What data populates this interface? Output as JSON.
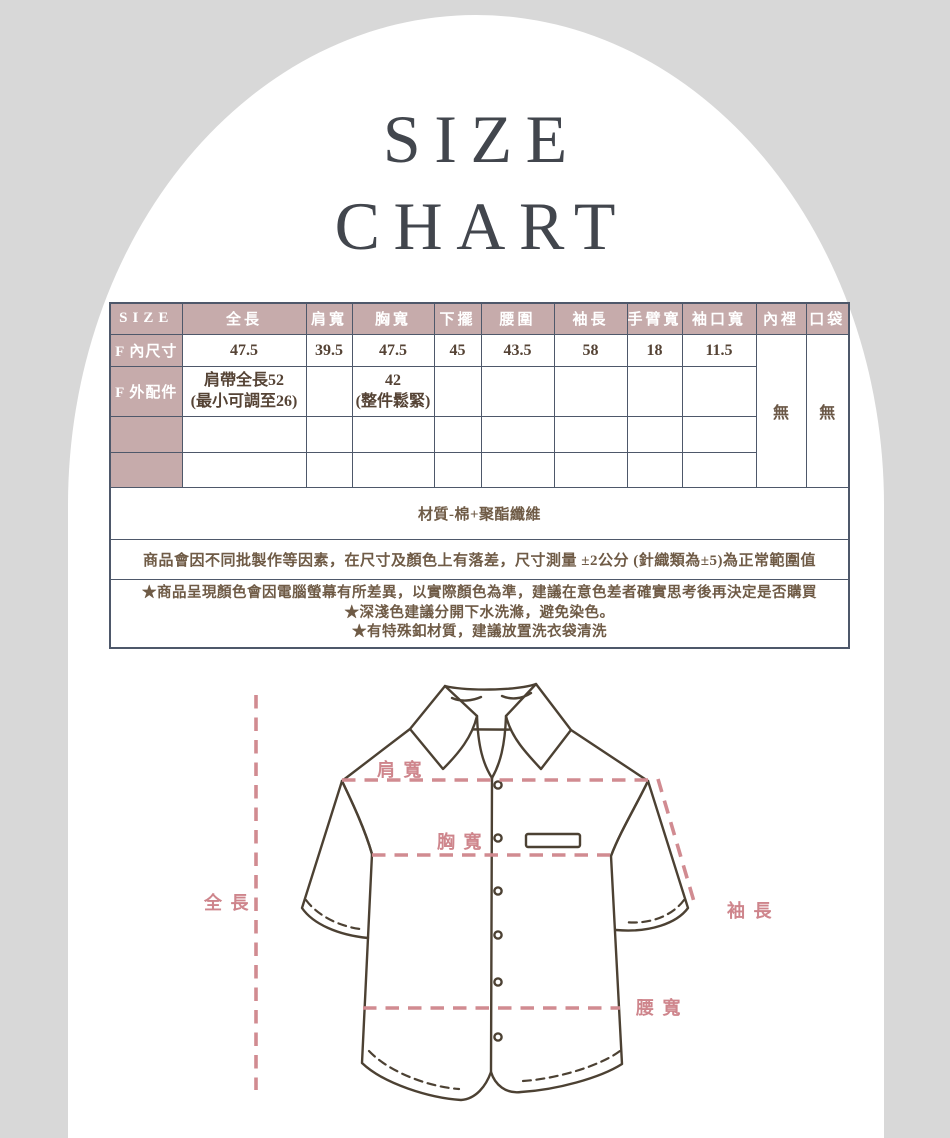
{
  "title": {
    "line1": "SIZE",
    "line2": "CHART"
  },
  "table": {
    "headers": [
      "SIZE",
      "全長",
      "肩寬",
      "胸寬",
      "下擺",
      "腰圍",
      "袖長",
      "手臂寬",
      "袖口寬",
      "內裡",
      "口袋"
    ],
    "row_inner": {
      "label": "F 內尺寸",
      "values": [
        "47.5",
        "39.5",
        "47.5",
        "45",
        "43.5",
        "58",
        "18",
        "11.5"
      ]
    },
    "row_outer": {
      "label": "F 外配件",
      "strap_note": "肩帶全長52\n(最小可調至26)",
      "chest_note": "42\n(整件鬆緊)"
    },
    "lining_value": "無",
    "pocket_value": "無",
    "material_note": "材質-棉+聚酯纖維",
    "tolerance_note": "商品會因不同批製作等因素，在尺寸及顏色上有落差，尺寸測量 ±2公分 (針織類為±5)為正常範圍值",
    "care_notes": {
      "n1": "★商品呈現顏色會因電腦螢幕有所差異，以實際顏色為準，建議在意色差者確實思考後再決定是否購買",
      "n2": "★深淺色建議分開下水洗滌，避免染色。",
      "n3": "★有特殊釦材質，建議放置洗衣袋清洗"
    }
  },
  "diagram": {
    "labels": {
      "shoulder": "肩 寬",
      "chest": "胸 寬",
      "length": "全 長",
      "sleeve": "袖 長",
      "waist": "腰 寬"
    }
  },
  "colors": {
    "background": "#d8d8d8",
    "panel": "#ffffff",
    "table_header_bg": "#c6abab",
    "table_header_text": "#ffffff",
    "table_border": "#4e586a",
    "table_value_text": "#554335",
    "note_text": "#6f5b46",
    "title_text": "#42464d",
    "shirt_outline": "#4c4133",
    "accent_pink": "#d18b91"
  }
}
